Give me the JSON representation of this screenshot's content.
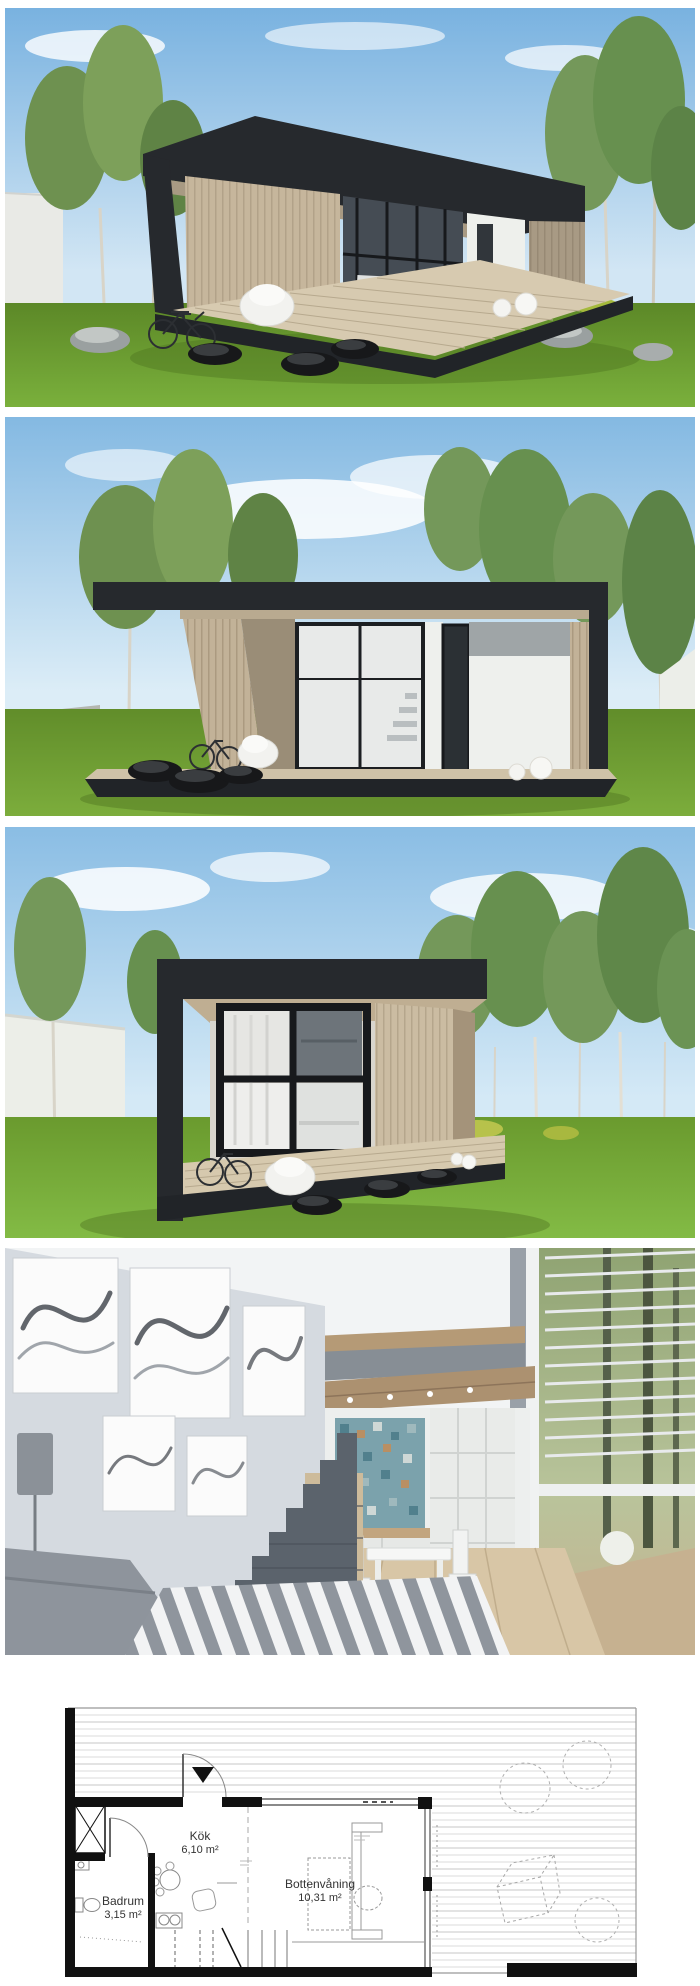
{
  "floor_plan": {
    "rooms": [
      {
        "name": "Kök",
        "area": "6,10 m²"
      },
      {
        "name": "Badrum",
        "area": "3,15 m²"
      },
      {
        "name": "Bottenvåning",
        "area": "10,31 m²"
      }
    ]
  },
  "colors": {
    "sky_blue": "#84b9e2",
    "grass_green": "#6f9e33",
    "frame_charcoal": "#26292d",
    "wood_tan": "#c6b69c",
    "deck_wood": "#d6c9ae",
    "white_wall": "#eef0ec",
    "interior_wall_gray": "#d5dae0",
    "loft_wood": "#b59a76",
    "mosaic_teal": "#7ba2ac",
    "plan_line_black": "#111111"
  }
}
